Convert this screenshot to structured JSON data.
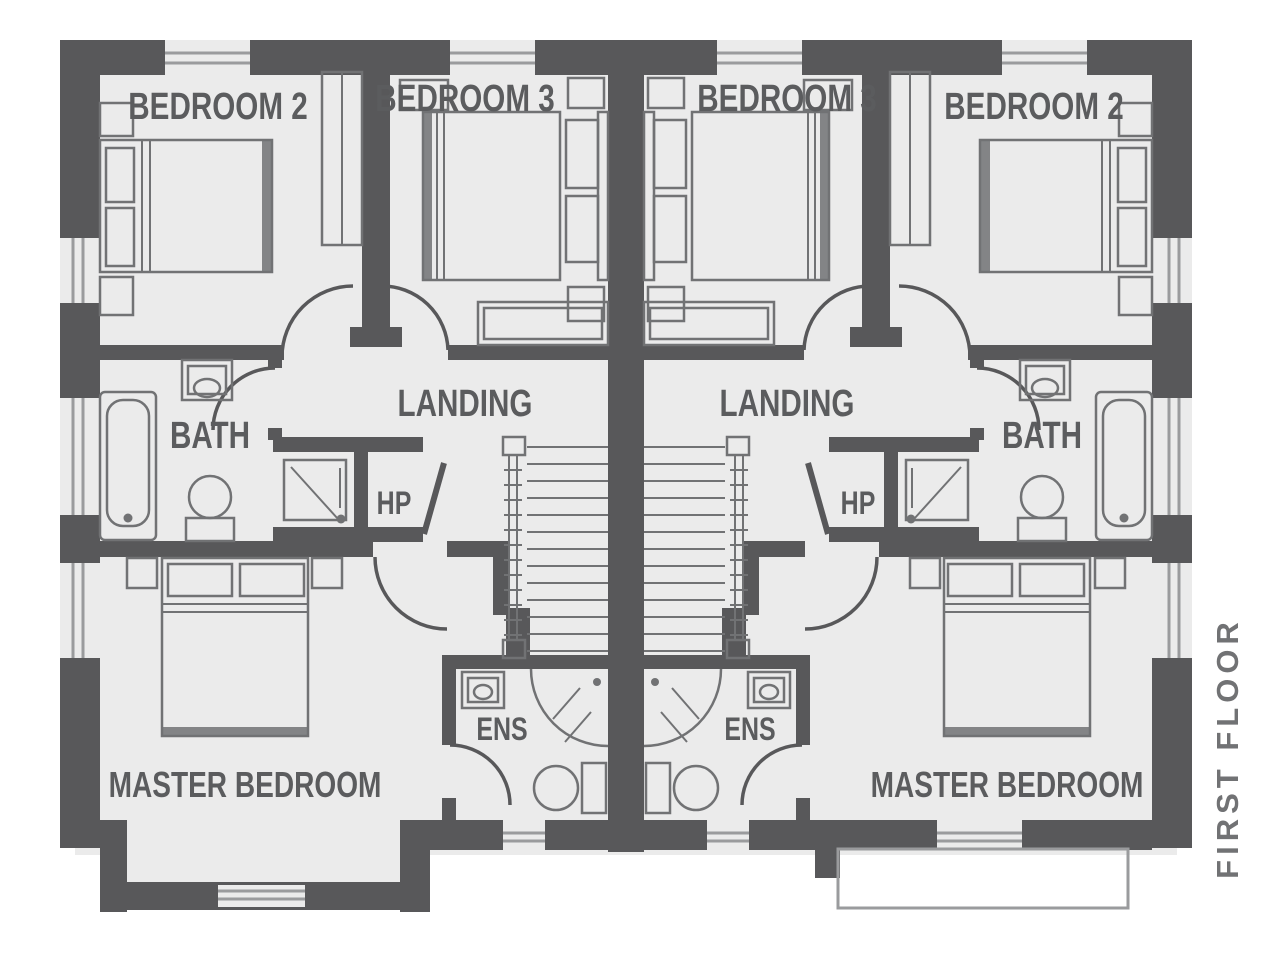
{
  "floor_plan": {
    "title": "FIRST FLOOR",
    "colors": {
      "background": "#ffffff",
      "floor": "#ebebeb",
      "wall": "#58585a",
      "line": "#717274",
      "window_line": "#9a9b9d",
      "text": "#5b5c5e"
    },
    "labels": {
      "bedroom2_left": "BEDROOM 2",
      "bedroom3_left": "BEDROOM 3",
      "bedroom3_right": "BEDROOM 3",
      "bedroom2_right": "BEDROOM 2",
      "bath_left": "BATH",
      "bath_right": "BATH",
      "landing_left": "LANDING",
      "landing_right": "LANDING",
      "hp_left": "HP",
      "hp_right": "HP",
      "ens_left": "ENS",
      "ens_right": "ENS",
      "master_left": "MASTER BEDROOM",
      "master_right": "MASTER BEDROOM",
      "floor_title": "FIRST FLOOR"
    },
    "units": [
      {
        "side": "left",
        "rooms": [
          "BEDROOM 2",
          "BEDROOM 3",
          "LANDING",
          "BATH",
          "HP",
          "ENS",
          "MASTER BEDROOM"
        ]
      },
      {
        "side": "right",
        "rooms": [
          "BEDROOM 3",
          "BEDROOM 2",
          "LANDING",
          "BATH",
          "HP",
          "ENS",
          "MASTER BEDROOM"
        ]
      }
    ]
  }
}
